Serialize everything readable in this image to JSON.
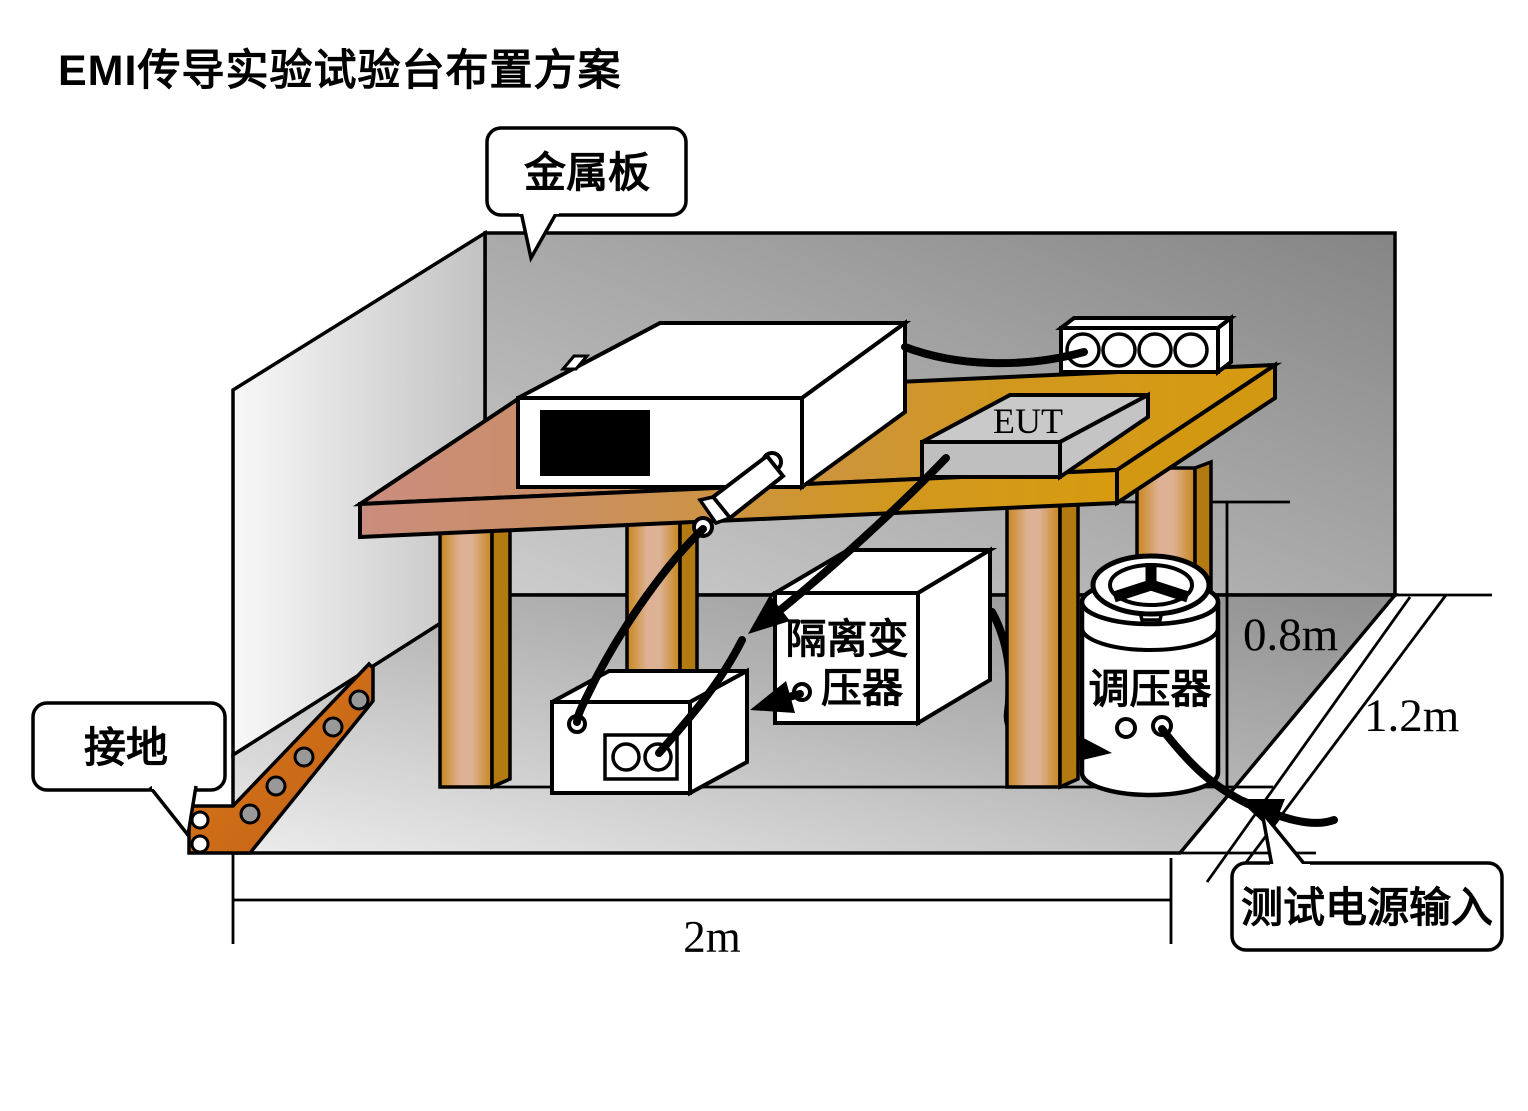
{
  "title": "EMI传导实验试验台布置方案",
  "callouts": {
    "metal_plate": "金属板",
    "ground": "接地",
    "power_input": "测试电源输入"
  },
  "labels": {
    "eut": "EUT",
    "transformer_line1": "隔离变",
    "transformer_line2": "压器",
    "regulator": "调压器"
  },
  "dimensions": {
    "table_height": "0.8m",
    "table_depth": "1.2m",
    "table_width": "2m"
  },
  "icons": {
    "ground-strap-icon": "copper strap with rivet holes",
    "variac-handwheel-icon": "three-spoke handwheel",
    "outlet-socket-icon": "four round sockets",
    "arrowhead-icon": "solid black cable arrow"
  },
  "colors": {
    "wood_gold": "#d79a10",
    "wood_pink": "#c9897c",
    "copper_strap": "#cc6b17",
    "wall_dark": "#878787",
    "wall_light": "#f6f6f6",
    "floor_dark": "#8f8f8f",
    "floor_light": "#eaeaea",
    "eut_gray": "#c9c9c9",
    "screen_black": "#000000",
    "line_black": "#000000",
    "box_white": "#ffffff"
  }
}
